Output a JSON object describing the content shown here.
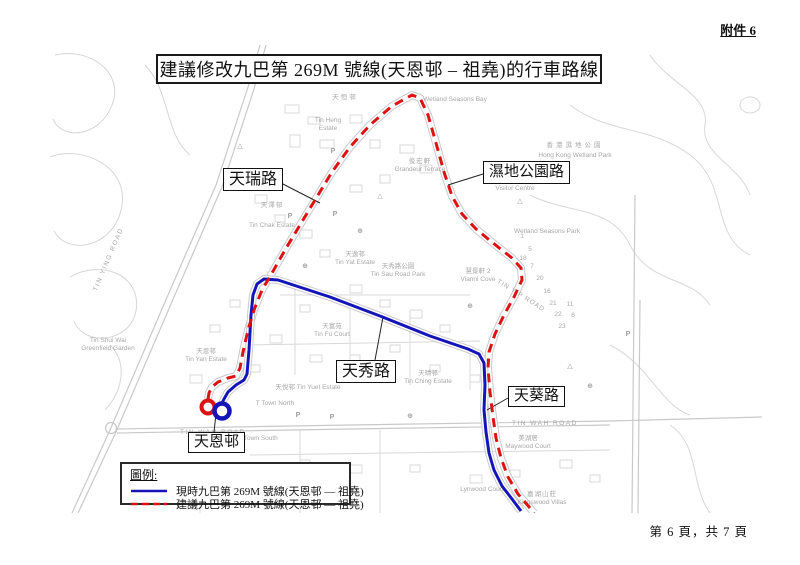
{
  "page": {
    "attachment_label": "附件 6",
    "title": "建議修改九巴第 269M 號線(天恩邨 – 祖堯)的行車路線",
    "footer_page": "第 6 頁，共 7 頁"
  },
  "colors": {
    "current_route_blue": "#1414b8",
    "proposed_route_red": "#dd1212"
  },
  "legend": {
    "heading": "圖例:",
    "items": [
      {
        "style": "solid-blue",
        "label": "現時九巴第 269M 號線(天恩邨 — 祖堯)"
      },
      {
        "style": "dashed-red",
        "label": "建議九巴第 269M 號線(天恩邨 — 祖堯)"
      }
    ]
  },
  "map": {
    "road_labels": {
      "tin_shui_road": "天瑞路",
      "wetland_park_road": "濕地公園路",
      "tin_sau_road": "天秀路",
      "tin_kwai_road": "天葵路",
      "tin_yan_estate": "天恩邨"
    },
    "icons": {
      "parking": "P",
      "pavilion": "△",
      "poi": "⊕"
    },
    "base_labels": {
      "greenfield_1": "Tin Shui Wai",
      "greenfield_2": "Greenfield Garden",
      "tin_ying_road": "TIN YING ROAD",
      "tin_heng_zh": "天恒邨",
      "tin_heng_1": "Tin Heng",
      "tin_heng_2": "Estate",
      "grandeur_zh": "俊宏軒",
      "grandeur_en": "Grandeur Terrace",
      "tin_chak_zh": "天澤邨",
      "tin_chak_en": "Tin Chak Estate",
      "wsb": "Wetland Seasons Bay",
      "hkwp_zh": "香港濕地公園",
      "hkwp_en": "Hong Kong Wetland Park",
      "visitor_zh": "訪客中心",
      "visitor_en": "Visitor Centre",
      "wsp": "Wetland Seasons Park",
      "tin_yat_zh": "天逸邨",
      "tin_yat_en": "Tin Yat Estate",
      "tsrp_zh": "天秀路公園",
      "tsrp_en": "Tin Sau Road Park",
      "vianni_zh": "慧景軒 2",
      "vianni_en": "Vianni Cove",
      "tin_fu_zh": "天富苑",
      "tin_fu_en": "Tin Fu Court",
      "tin_yuet": "天悅邨  Tin Yuet Estate",
      "tin_ching_zh": "天晴邨",
      "tin_ching_en": "Tin Ching Estate",
      "tin_yan_zh": "天恩邨",
      "tin_yan_en": "Tin Yan Estate",
      "t_town_north": "T Town North",
      "t_town_south": "T Town South",
      "tin_wah_road": "TIN WAH ROAD",
      "tin_yip_road": "TIN YIP ROAD",
      "maywood_zh": "美湖居",
      "maywood_en": "Maywood Court",
      "lynwood": "Lynwood Court",
      "kingswood_zh": "嘉湖山莊",
      "kingswood_en": "Kingswood Villas",
      "n1": "1",
      "n5": "5",
      "n7": "7",
      "n18": "18",
      "n20": "20",
      "n16": "16",
      "n21": "21",
      "n11": "11",
      "n22": "22",
      "n6": "6",
      "n23": "23"
    }
  }
}
